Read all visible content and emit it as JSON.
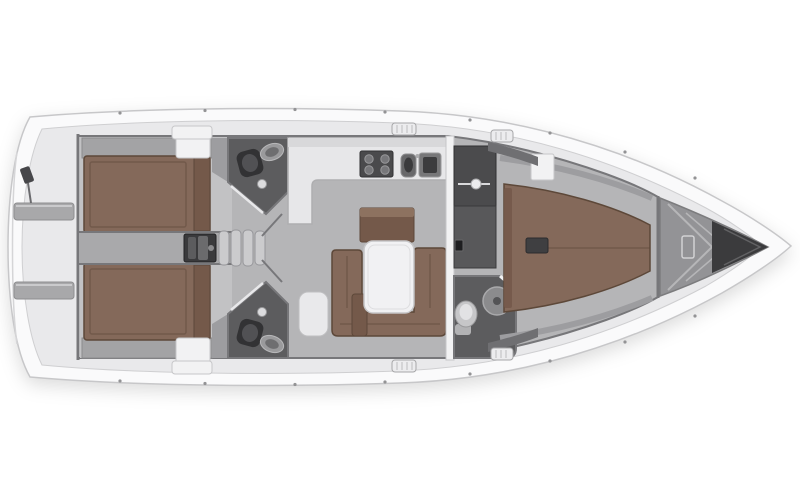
{
  "canvas": {
    "width": 800,
    "height": 500,
    "background": "#ffffff"
  },
  "palette": {
    "page_bg": "#ffffff",
    "hull": "#fafafb",
    "hull_edge": "#c7c7c9",
    "deck": "#e9e9eb",
    "deck_edge": "#cfcfd1",
    "floor": "#b5b5b7",
    "floor_light": "#c2c2c4",
    "corridor": "#a9a9ab",
    "wall": "#77777a",
    "wall_light": "#f2f2f3",
    "counter": "#e7e7e9",
    "wood": "#84695a",
    "wood_mid": "#74594a",
    "wood_dark": "#5d4839",
    "head_floor": "#5c5c5e",
    "fixture_dark": "#323234",
    "bench": "#a8a8aa",
    "engine": "#3a3a3c",
    "step": "#cbcbcd",
    "forepeak": "#939396",
    "anchor": "#3b3b3d"
  },
  "vessel": {
    "view": "top-down-floor-plan",
    "orientation": "bow-right-stern-left",
    "rooms": [
      {
        "name": "swim-platform",
        "features": [
          "transom-benches",
          "boarding-ladder"
        ]
      },
      {
        "name": "cockpit",
        "features": [
          "helm-seats"
        ]
      },
      {
        "name": "aft-cabin-port",
        "features": [
          "double-berth",
          "wardrobe",
          "shelf"
        ]
      },
      {
        "name": "aft-cabin-starboard",
        "features": [
          "double-berth",
          "wardrobe",
          "shelf"
        ]
      },
      {
        "name": "engine-compartment",
        "features": [
          "engine-block",
          "companionway-steps"
        ]
      },
      {
        "name": "aft-head-port",
        "features": [
          "toilet",
          "washbasin",
          "shower"
        ]
      },
      {
        "name": "aft-head-starboard",
        "features": [
          "toilet",
          "washbasin",
          "shower"
        ]
      },
      {
        "name": "galley",
        "features": [
          "stove",
          "double-sink",
          "l-shaped-counter"
        ]
      },
      {
        "name": "salon",
        "features": [
          "u-shaped-sofa",
          "table",
          "sideboard",
          "bench-seat",
          "pouf"
        ]
      },
      {
        "name": "wardrobe-lockers",
        "features": [
          "hanging-rod",
          "locker"
        ]
      },
      {
        "name": "forward-head",
        "features": [
          "toilet",
          "shower"
        ]
      },
      {
        "name": "forward-cabin",
        "features": [
          "island-double-berth",
          "step-box",
          "bow-cabinets"
        ]
      },
      {
        "name": "forepeak",
        "features": [
          "anchor-locker",
          "hull-ribs"
        ]
      }
    ]
  }
}
